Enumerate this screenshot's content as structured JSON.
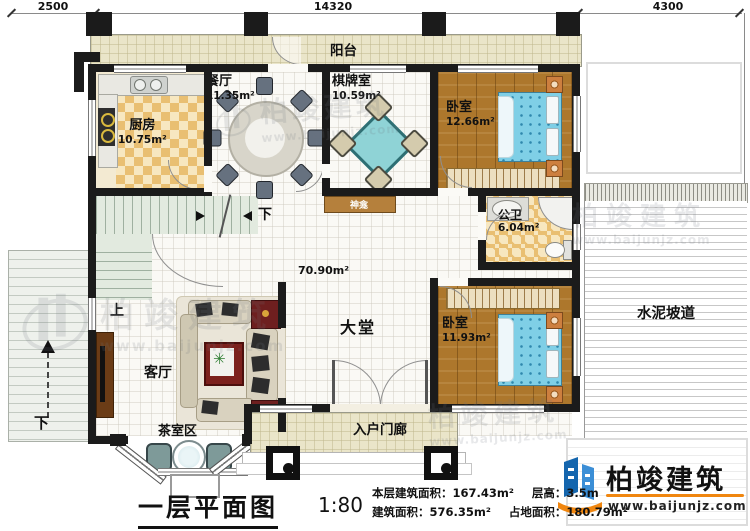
{
  "dimensions": {
    "top_left": "2500",
    "top_center": "14320",
    "top_right": "4300",
    "right_side": "13180"
  },
  "rooms": {
    "balcony": {
      "name": "阳台"
    },
    "dining": {
      "name": "餐厅",
      "area": "11.35m²"
    },
    "kitchen": {
      "name": "厨房",
      "area": "10.75m²"
    },
    "mahjong": {
      "name": "棋牌室",
      "area": "10.59m²"
    },
    "bedroom_top": {
      "name": "卧室",
      "area": "12.66m²"
    },
    "shrine": {
      "name": "神龛"
    },
    "bathroom": {
      "name": "公卫",
      "area": "6.04m²"
    },
    "hall": {
      "name": "大堂",
      "area": "70.90m²"
    },
    "bedroom_bottom": {
      "name": "卧室",
      "area": "11.93m²"
    },
    "living": {
      "name": "客厅"
    },
    "tea_area": {
      "name": "茶室区"
    },
    "porch": {
      "name": "入户门廊"
    },
    "ramp": {
      "name": "水泥坡道"
    }
  },
  "stairs": {
    "up_label": "上",
    "down_label_inner": "下",
    "down_label_outer": "下"
  },
  "title_block": {
    "title": "一层平面图",
    "scale": "1:80",
    "floor_area_label": "本层建筑面积：",
    "floor_area_value": "167.43m²",
    "height_label": "层高：",
    "height_value": "3.5m",
    "total_area_label": "建筑面积：",
    "total_area_value": "576.35m²",
    "land_area_label": "占地面积：",
    "land_area_value": "180.79m²"
  },
  "logo": {
    "name": "柏竣建筑",
    "url": "www.baijunjz.com"
  },
  "watermark": {
    "name": "柏竣建筑",
    "url": "www.baijunjz.com"
  },
  "icons": {
    "plant": "✳"
  },
  "colors": {
    "wall": "#1b1b1b",
    "wood_floor": "#ad772c",
    "bed_blue": "#7fcfe6",
    "logo_blue": "#1566ae",
    "logo_orange": "#f0860f",
    "shrine_brown": "#b5803c"
  }
}
